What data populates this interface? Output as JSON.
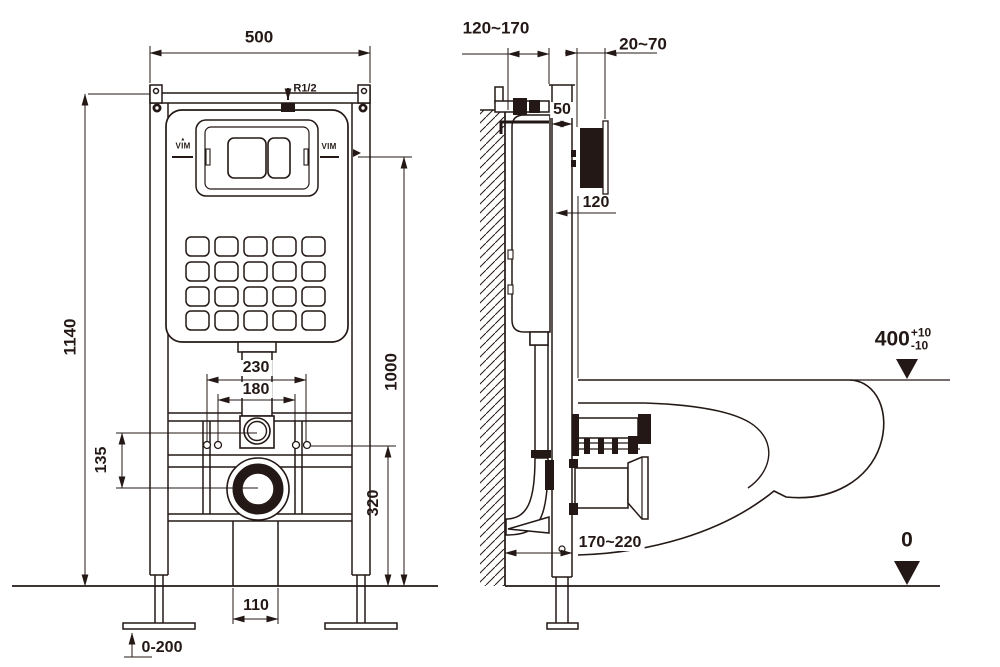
{
  "title": "Wall-hung WC concealed cistern frame installation drawing",
  "brand": "VIM",
  "front": {
    "dim_width": "500",
    "dim_height": "1140",
    "dim_bolt_outer": "230",
    "dim_bolt_inner": "180",
    "dim_offset_flush_to_drain": "135",
    "dim_inlet_height": "1000",
    "dim_bolt_height": "320",
    "dim_outlet_gap": "110",
    "dim_feet_range": "0-200",
    "water_inlet": "R1/2"
  },
  "side": {
    "dim_wall_to_frame": "120~170",
    "dim_finish_thickness": "20~70",
    "dim_frame_depth": "50",
    "dim_plate": "120",
    "dim_outlet_offset": "170~220",
    "rim_height": "400",
    "rim_tol_plus": "+10",
    "rim_tol_minus": "-10",
    "floor_level": "0"
  }
}
